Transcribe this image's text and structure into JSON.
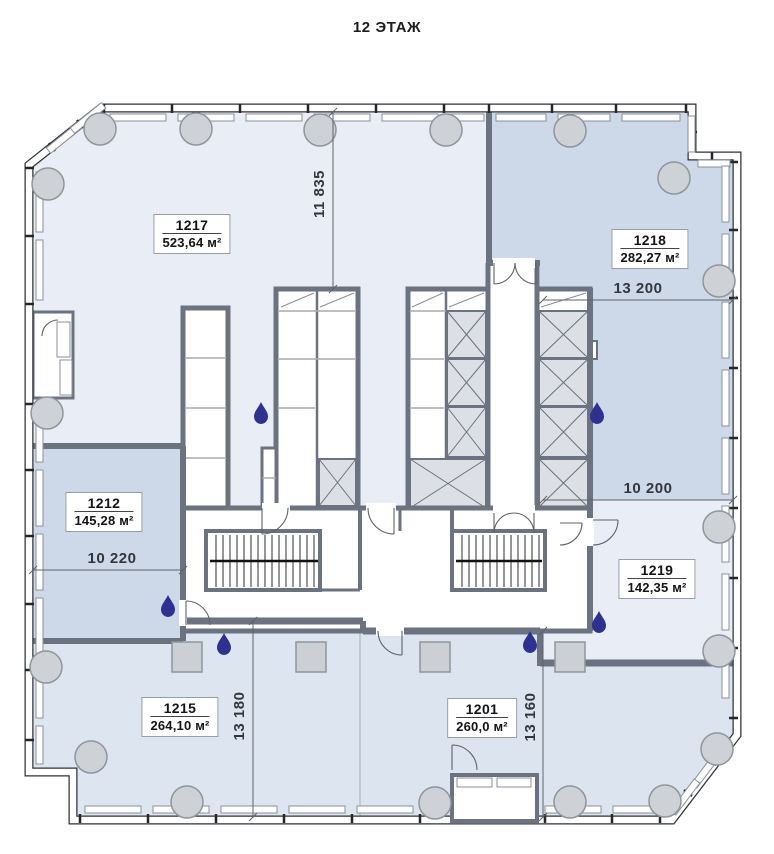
{
  "title": "12 ЭТАЖ",
  "units": [
    {
      "number": "1217",
      "area": "523,64 м²"
    },
    {
      "number": "1218",
      "area": "282,27 м²"
    },
    {
      "number": "1212",
      "area": "145,28 м²"
    },
    {
      "number": "1219",
      "area": "142,35 м²"
    },
    {
      "number": "1215",
      "area": "264,10 м²"
    },
    {
      "number": "1201",
      "area": "260,0 м²"
    }
  ],
  "dimensions": {
    "top_center_vertical": "11 835",
    "right_upper_horizontal": "13 200",
    "right_middle_horizontal": "10 200",
    "left_middle_horizontal": "10 220",
    "bottom_left_vertical": "13 180",
    "bottom_center_vertical": "13 160"
  },
  "icons": {
    "water_drop": "water-drop-icon"
  },
  "colors": {
    "zone_light": "#e9eef6",
    "zone_dark": "#cdd9e9",
    "zone_mid": "#dde6f0",
    "zone_mid2": "#dbe4ef",
    "wall": "#6b7280",
    "water_drop": "#2e3192",
    "column_fill": "#ced2d6",
    "shaft_fill": "#dcdfe3"
  }
}
